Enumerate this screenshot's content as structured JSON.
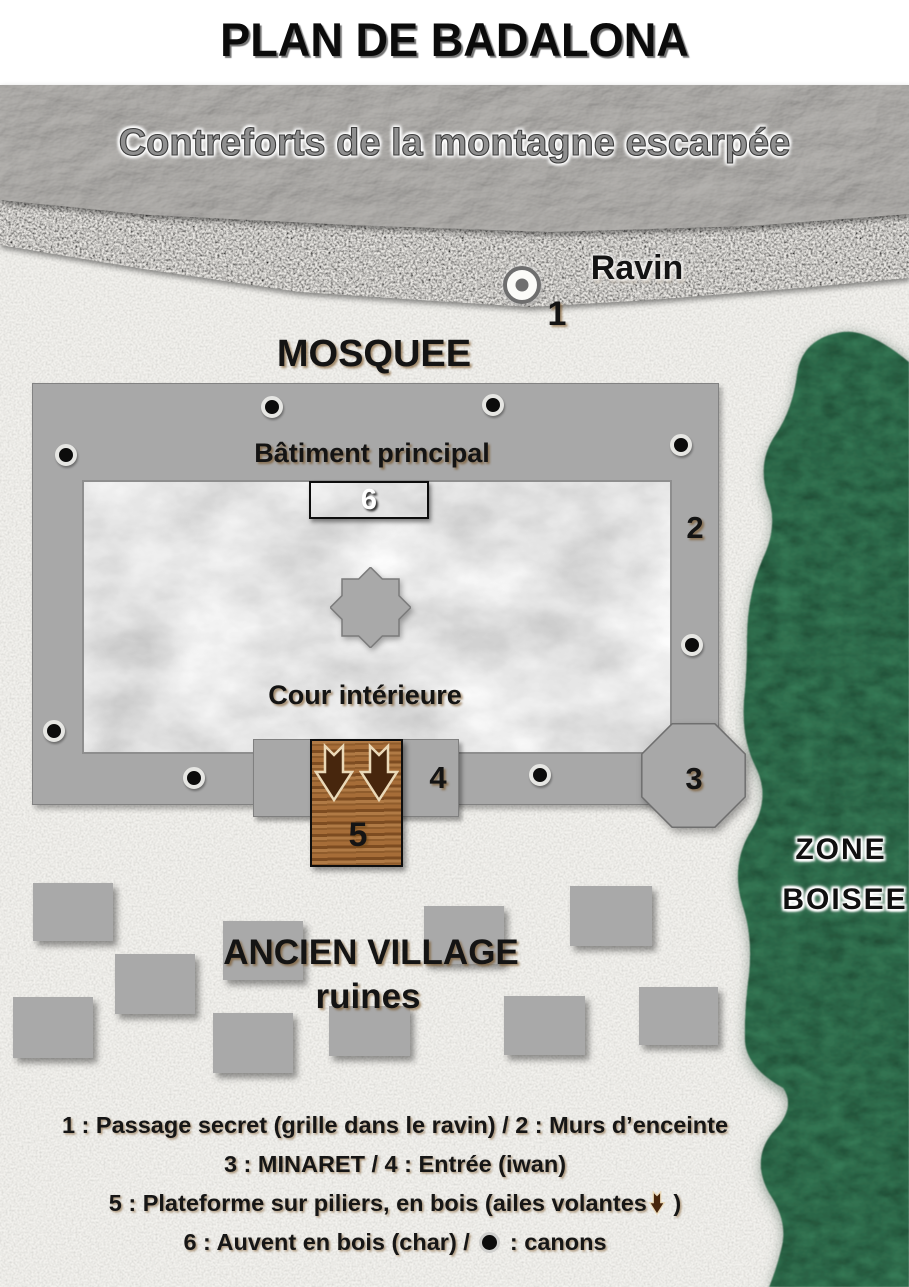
{
  "title": "PLAN DE BADALONA",
  "mountain": {
    "label": "Contreforts de la montagne escarpée"
  },
  "ravine": {
    "label": "Ravin",
    "marker_number": "1"
  },
  "mosque": {
    "label": "MOSQUEE",
    "main_building_label": "Bâtiment principal",
    "courtyard_label": "Cour intérieure",
    "awning_number": "6",
    "walls_number": "2",
    "minaret_number": "3",
    "entrance_number": "4",
    "platform_number": "5",
    "canons": [
      {
        "x": 272,
        "y": 407
      },
      {
        "x": 493,
        "y": 405
      },
      {
        "x": 66,
        "y": 455
      },
      {
        "x": 681,
        "y": 445
      },
      {
        "x": 54,
        "y": 731
      },
      {
        "x": 692,
        "y": 645
      },
      {
        "x": 194,
        "y": 778
      },
      {
        "x": 540,
        "y": 775
      }
    ]
  },
  "zone_boisee": {
    "line1": "ZONE",
    "line2": "BOISEE"
  },
  "village": {
    "label_line1": "ANCIEN VILLAGE",
    "label_line2": "ruines",
    "blocks": [
      {
        "x": 33,
        "y": 883,
        "w": 80,
        "h": 58
      },
      {
        "x": 115,
        "y": 954,
        "w": 80,
        "h": 60
      },
      {
        "x": 13,
        "y": 997,
        "w": 80,
        "h": 61
      },
      {
        "x": 223,
        "y": 921,
        "w": 80,
        "h": 59
      },
      {
        "x": 213,
        "y": 1013,
        "w": 80,
        "h": 60
      },
      {
        "x": 329,
        "y": 1006,
        "w": 81,
        "h": 50
      },
      {
        "x": 424,
        "y": 906,
        "w": 80,
        "h": 58
      },
      {
        "x": 570,
        "y": 886,
        "w": 82,
        "h": 60
      },
      {
        "x": 504,
        "y": 996,
        "w": 81,
        "h": 59
      },
      {
        "x": 639,
        "y": 987,
        "w": 79,
        "h": 58
      }
    ]
  },
  "legend": {
    "line1": "1 : Passage secret (grille dans le ravin) / 2 : Murs d’enceinte",
    "line2": "3 : MINARET  / 4 : Entrée (iwan)",
    "line3_prefix": "5 : Plateforme sur piliers, en bois (ailes volantes",
    "line3_suffix": " )",
    "line4_prefix": "6 : Auvent en bois (char) /  ",
    "line4_suffix": " : canons"
  },
  "icons": {
    "wing_arrow_icon": "⬇ brown block arrow",
    "canon_icon": "● black dot with gray ring"
  },
  "colors": {
    "wall_gray": "#a8a8a8",
    "wood_dark": "#3e2e1f",
    "wood_light": "#9c6a38",
    "forest_green": "#357a56",
    "paper": "#f3f2ee",
    "marble": "#fcfcfc",
    "text_black": "#111111"
  }
}
